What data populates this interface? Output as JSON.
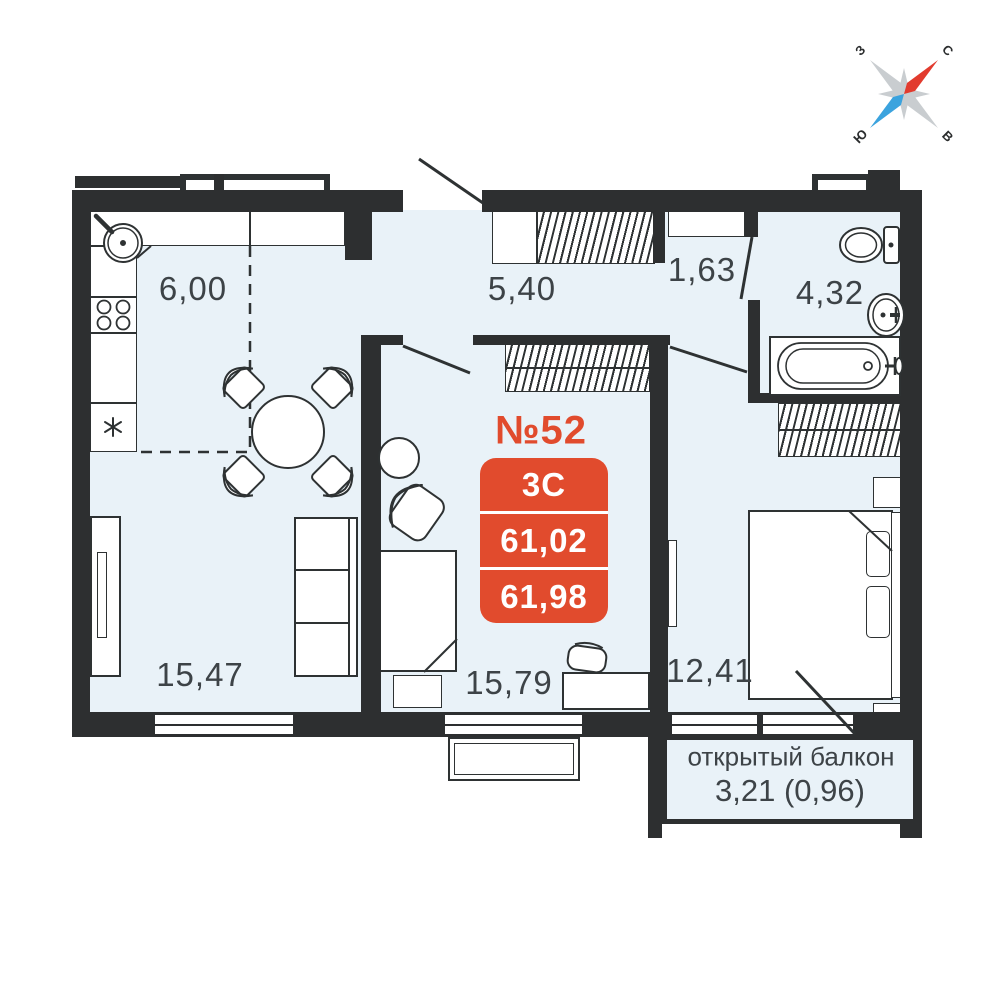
{
  "plan": {
    "unit_label": "№52",
    "badge": {
      "type": "3С",
      "area_top": "61,02",
      "area_bottom": "61,98"
    },
    "rooms": {
      "kitchen": "6,00",
      "hallway": "5,40",
      "storage": "1,63",
      "bathroom": "4,32",
      "living": "15,47",
      "room": "15,79",
      "bedroom": "12,41"
    },
    "balcony": {
      "title": "открытый балкон",
      "area": "3,21 (0,96)"
    },
    "compass": {
      "north": "С",
      "south": "Ю",
      "west": "З",
      "east": "В"
    },
    "colors": {
      "accent": "#e14b2d",
      "wall": "#2d2f30",
      "floor": "#e9f2f8",
      "line": "#2e3233"
    }
  }
}
